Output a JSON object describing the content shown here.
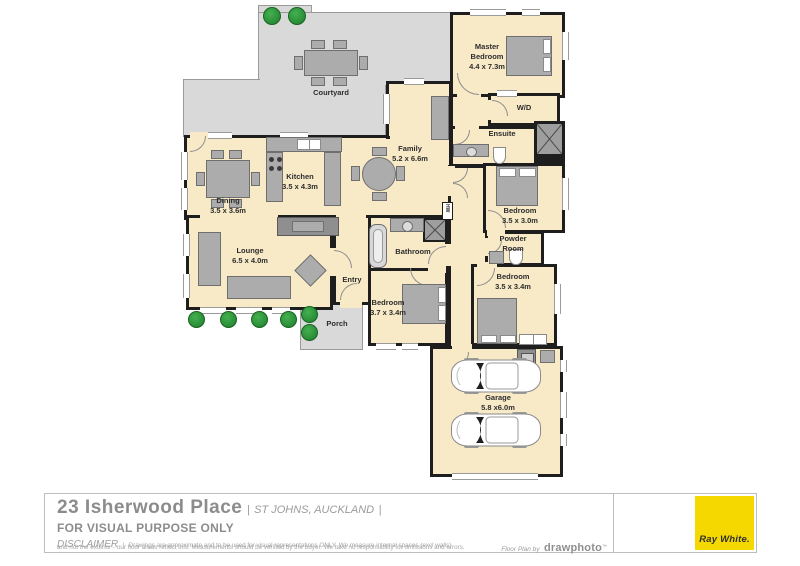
{
  "meta": {
    "brand_yellow": "#F5D800",
    "room_fill": "#F8EAC7",
    "wall_color": "#1E1E1E",
    "outdoor_fill": "#D9D9D9"
  },
  "plan": {
    "courtyard": {
      "label": "Courtyard"
    },
    "porch": {
      "label": "Porch"
    },
    "entry": {
      "label": "Entry"
    },
    "master_bedroom": {
      "line1": "Master",
      "line2": "Bedroom",
      "dims": "4.4 x 7.3m"
    },
    "wd": {
      "label": "W/D"
    },
    "ensuite": {
      "label": "Ensuite"
    },
    "family": {
      "name": "Family",
      "dims": "5.2 x 6.6m"
    },
    "kitchen": {
      "name": "Kitchen",
      "dims": "3.5 x 4.3m"
    },
    "dining": {
      "name": "Dining",
      "dims": "3.5 x 3.6m"
    },
    "lounge": {
      "name": "Lounge",
      "dims": "6.5 x 4.0m"
    },
    "bathroom": {
      "label": "Bathroom"
    },
    "bedroom_left": {
      "name": "Bedroom",
      "dims": "3.7 x 3.4m"
    },
    "bedroom_right_top": {
      "name": "Bedroom",
      "dims": "3.5 x 3.0m"
    },
    "powder_room": {
      "line1": "Powder",
      "line2": "Room"
    },
    "bedroom_right_bottom": {
      "name": "Bedroom",
      "dims": "3.5 x 3.4m"
    },
    "garage": {
      "name": "Garage",
      "dims": "5.8 x6.0m"
    },
    "hw": {
      "label": "HW"
    }
  },
  "footer": {
    "address": "23 Isherwood Place",
    "separator_left": "|",
    "locality": "ST JOHNS, AUCKLAND",
    "separator_right": "|",
    "visual_purpose": "FOR VISUAL PURPOSE ONLY",
    "disclaimer_label": "DISCLAIMER",
    "disclaimer_separator": "|",
    "disclaimer_line1": "Drawings are approximate and to be used for visual representations ONLY. We measure internal spaces (excl walls)",
    "disclaimer_line2": "and not the exterior - our floor areas reflect this. Measurements should be verified by the buyer. We take no responsibility for omissions and errors.",
    "credit_prefix": "Floor Plan by",
    "credit_brand": "drawphoto",
    "credit_tm": "™",
    "brand": "Ray White."
  }
}
